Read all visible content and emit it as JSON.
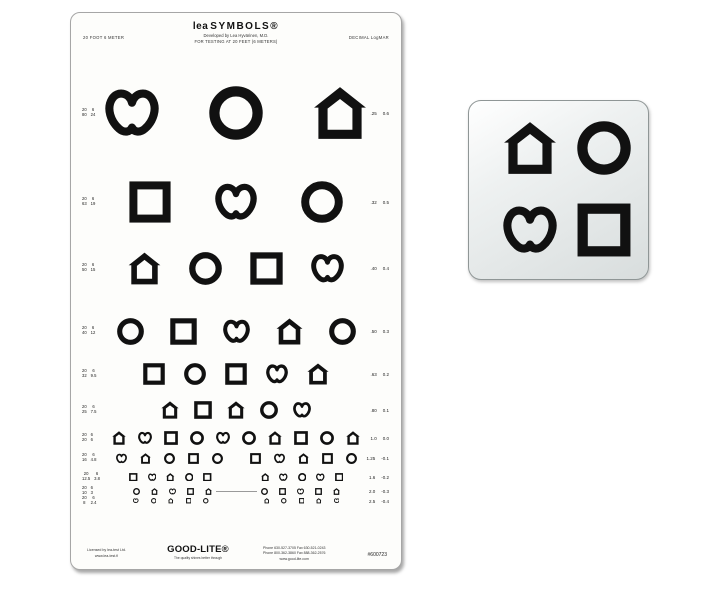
{
  "colors": {
    "symbol": "#111111",
    "chart_bg": "#fdfdfb",
    "chart_border": "#a6a6a6",
    "key_card_border": "#8f9696",
    "divider": "#9a9a9a"
  },
  "chart": {
    "title_lea": "lea",
    "title_rest": "SYMBOLS®",
    "subtitle1": "Developed by Lea Hyvärinen, M.D.",
    "subtitle2": "FOR TESTING AT 20 FEET (6 METERS)",
    "left_header": "20 FOOT   6 METER",
    "right_header": "DECIMAL   LogMAR",
    "rows": [
      {
        "foot_num": "20",
        "foot_den": "80",
        "meter_num": "6",
        "meter_den": "24",
        "decimal": ".25",
        "logmar": "0.6",
        "size": 54,
        "gap": 50,
        "top": 100,
        "groups": [
          [
            "heart",
            "circle",
            "house"
          ]
        ]
      },
      {
        "foot_num": "20",
        "foot_den": "63",
        "meter_num": "6",
        "meter_den": "19",
        "decimal": ".32",
        "logmar": "0.5",
        "size": 42,
        "gap": 44,
        "top": 189,
        "groups": [
          [
            "square",
            "heart",
            "circle"
          ]
        ]
      },
      {
        "foot_num": "20",
        "foot_den": "50",
        "meter_num": "6",
        "meter_den": "15",
        "decimal": ".40",
        "logmar": "0.4",
        "size": 33,
        "gap": 28,
        "top": 255,
        "groups": [
          [
            "house",
            "circle",
            "square",
            "heart"
          ]
        ]
      },
      {
        "foot_num": "20",
        "foot_den": "40",
        "meter_num": "6",
        "meter_den": "12",
        "decimal": ".50",
        "logmar": "0.3",
        "size": 27,
        "gap": 26,
        "top": 318,
        "groups": [
          [
            "circle",
            "square",
            "heart",
            "house",
            "circle"
          ]
        ]
      },
      {
        "foot_num": "20",
        "foot_den": "32",
        "meter_num": "6",
        "meter_den": "9.5",
        "decimal": ".63",
        "logmar": "0.2",
        "size": 22,
        "gap": 19,
        "top": 361,
        "groups": [
          [
            "square",
            "circle",
            "square",
            "heart",
            "house"
          ]
        ]
      },
      {
        "foot_num": "20",
        "foot_den": "25",
        "meter_num": "6",
        "meter_den": "7.5",
        "decimal": ".80",
        "logmar": "0.1",
        "size": 18,
        "gap": 15,
        "top": 397,
        "groups": [
          [
            "house",
            "square",
            "house",
            "circle",
            "heart"
          ]
        ]
      },
      {
        "foot_num": "20",
        "foot_den": "20",
        "meter_num": "6",
        "meter_den": "6",
        "decimal": "1.0",
        "logmar": "0.0",
        "size": 14,
        "gap": 12,
        "top": 425,
        "groups": [
          [
            "house",
            "heart",
            "square",
            "circle",
            "heart",
            "circle",
            "house",
            "square",
            "circle",
            "house"
          ]
        ]
      },
      {
        "foot_num": "20",
        "foot_den": "16",
        "meter_num": "6",
        "meter_den": "4.8",
        "decimal": "1.25",
        "logmar": "-0.1",
        "size": 11,
        "gap": 13,
        "center_gap": 27,
        "top": 445,
        "groups": [
          [
            "heart",
            "house",
            "circle",
            "square",
            "circle"
          ],
          [
            "square",
            "heart",
            "house",
            "square",
            "circle"
          ]
        ]
      },
      {
        "foot_num": "20",
        "foot_den": "12.5",
        "meter_num": "6",
        "meter_den": "3.8",
        "decimal": "1.6",
        "logmar": "-0.2",
        "size": 8.5,
        "gap": 10,
        "center_gap": 49,
        "top": 464,
        "groups": [
          [
            "square",
            "heart",
            "house",
            "circle",
            "square"
          ],
          [
            "house",
            "heart",
            "circle",
            "heart",
            "square"
          ]
        ]
      },
      {
        "foot_num": "20",
        "foot_den": "10",
        "meter_num": "6",
        "meter_den": "3",
        "decimal": "2.0",
        "logmar": "-0.3",
        "size": 7,
        "gap": 11,
        "center_gap": 49,
        "divider": true,
        "divider_width": 41,
        "top": 478,
        "groups": [
          [
            "circle",
            "house",
            "heart",
            "square",
            "house"
          ],
          [
            "circle",
            "square",
            "heart",
            "square",
            "house"
          ]
        ]
      },
      {
        "foot_num": "20",
        "foot_den": "8",
        "meter_num": "6",
        "meter_den": "2.4",
        "decimal": "2.5",
        "logmar": "-0.4",
        "size": 5.5,
        "gap": 12,
        "center_gap": 55,
        "top": 488,
        "groups": [
          [
            "heart",
            "circle",
            "house",
            "square",
            "circle"
          ],
          [
            "house",
            "circle",
            "square",
            "house",
            "heart"
          ]
        ]
      }
    ],
    "footer": {
      "licensed1": "Licensed by lea-test Ltd.",
      "licensed2": "www.lea-test.fi",
      "brand": "GOOD-LITE®",
      "tagline": "The quality shines better through",
      "contact1": "Phone 630-527-3705   Fax 630-521-0243",
      "contact2": "Phone 800-362-3860   Fax 888-362-2576",
      "contact3": "www.good-lite.com",
      "item_number": "#600723"
    }
  },
  "key_card": {
    "symbols": [
      "house",
      "circle",
      "heart",
      "square"
    ],
    "symbol_size": 54
  }
}
